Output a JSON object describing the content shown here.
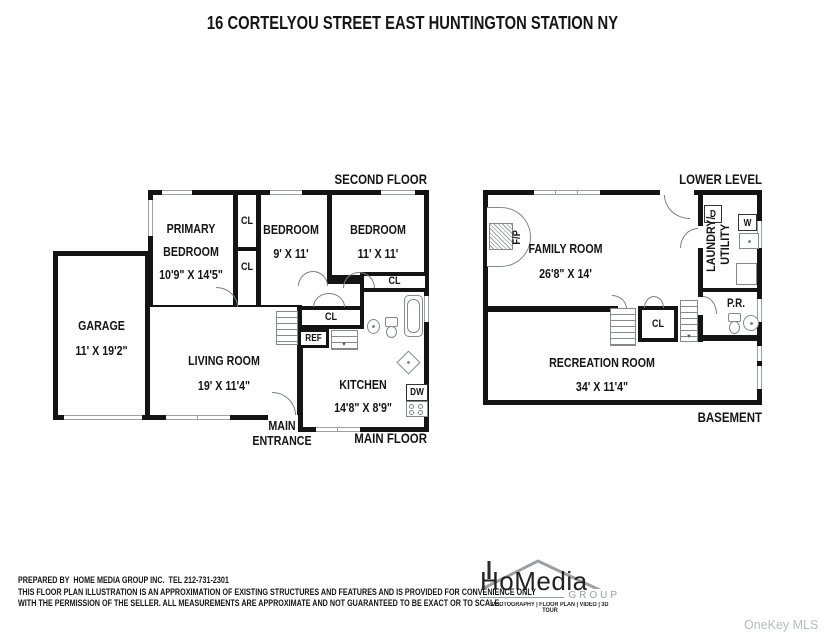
{
  "title": "16 CORTELYOU STREET EAST HUNTINGTON STATION NY",
  "watermark": "OneKey MLS",
  "upper_plan": {
    "level_label": "SECOND FLOOR",
    "floor_label": "MAIN FLOOR",
    "entrance_line1": "MAIN",
    "entrance_line2": "ENTRANCE",
    "primary_bedroom": {
      "name": "PRIMARY BEDROOM",
      "dims": "10'9\" X 14'5\""
    },
    "closet_top": "CL",
    "closet_mid": "CL",
    "closet_bath": "CL",
    "closet_hall": "CL",
    "bedroom_middle": {
      "name": "BEDROOM",
      "dims": "9' X 11'"
    },
    "bedroom_right": {
      "name": "BEDROOM",
      "dims": "11' X 11'"
    },
    "garage": {
      "name": "GARAGE",
      "dims": "11' X 19'2\""
    },
    "living_room": {
      "name": "LIVING ROOM",
      "dims": "19' X 11'4\""
    },
    "kitchen": {
      "name": "KITCHEN",
      "dims": "14'8\" X 8'9\""
    },
    "fridge_label": "REF",
    "dishwasher_label": "DW"
  },
  "lower_plan": {
    "level_label": "LOWER LEVEL",
    "floor_label": "BASEMENT",
    "family_room": {
      "name": "FAMILY ROOM",
      "dims": "26'8\" X 14'"
    },
    "recreation_room": {
      "name": "RECREATION ROOM",
      "dims": "34' X 11'4\""
    },
    "fireplace_label": "F/P",
    "laundry_line1": "LAUNDRY/",
    "laundry_line2": "UTILITY",
    "dryer_label": "D",
    "washer_label": "W",
    "powder_room_label": "P.R.",
    "closet_label": "CL"
  },
  "footer": {
    "prepared_line": "PREPARED BY  HOME MEDIA GROUP INC.  TEL 212-731-2301",
    "disclaimer_line1": "THIS FLOOR PLAN ILLUSTRATION IS AN APPROXIMATION OF EXISTING STRUCTURES AND FEATURES AND IS PROVIDED FOR CONVENIENCE ONLY",
    "disclaimer_line2": "WITH THE PERMISSION OF THE SELLER. ALL MEASUREMENTS ARE APPROXIMATE AND NOT GUARANTEED TO BE EXACT OR TO SCALE."
  },
  "logo": {
    "brand": "HoMedia",
    "sub": "GROUP",
    "tagline": "PHOTOGRAPHY | FLOOR PLAN | VIDEO | 3D TOUR"
  },
  "colors": {
    "wall": "#141414",
    "fixture": "#84898e",
    "logo_gray": "#9aa0a5",
    "watermark": "#b5bdc4"
  }
}
